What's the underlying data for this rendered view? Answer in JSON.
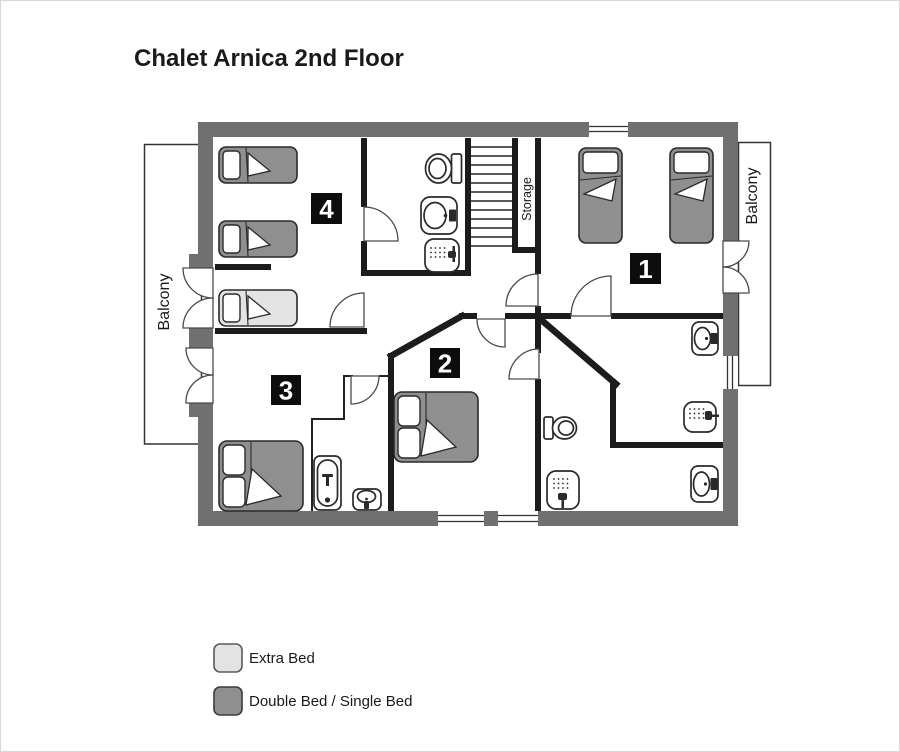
{
  "title": "Chalet Arnica 2nd Floor",
  "plan": {
    "balcony_left": "Balcony",
    "balcony_right": "Balcony",
    "storage": "Storage",
    "rooms": [
      {
        "number": "1"
      },
      {
        "number": "2"
      },
      {
        "number": "3"
      },
      {
        "number": "4"
      }
    ]
  },
  "legend": {
    "items": [
      {
        "label": "Extra Bed",
        "color": "#e3e3e3"
      },
      {
        "label": "Double Bed / Single Bed",
        "color": "#8f8f8f"
      }
    ]
  },
  "colors": {
    "exterior_wall": "#707070",
    "interior_wall": "#1c1c1c",
    "fixture_outline": "#2a2a2a",
    "standard_bed": "#8f8f8f",
    "extra_bed": "#e3e3e3",
    "text": "#1a1a1a",
    "background": "#ffffff"
  }
}
